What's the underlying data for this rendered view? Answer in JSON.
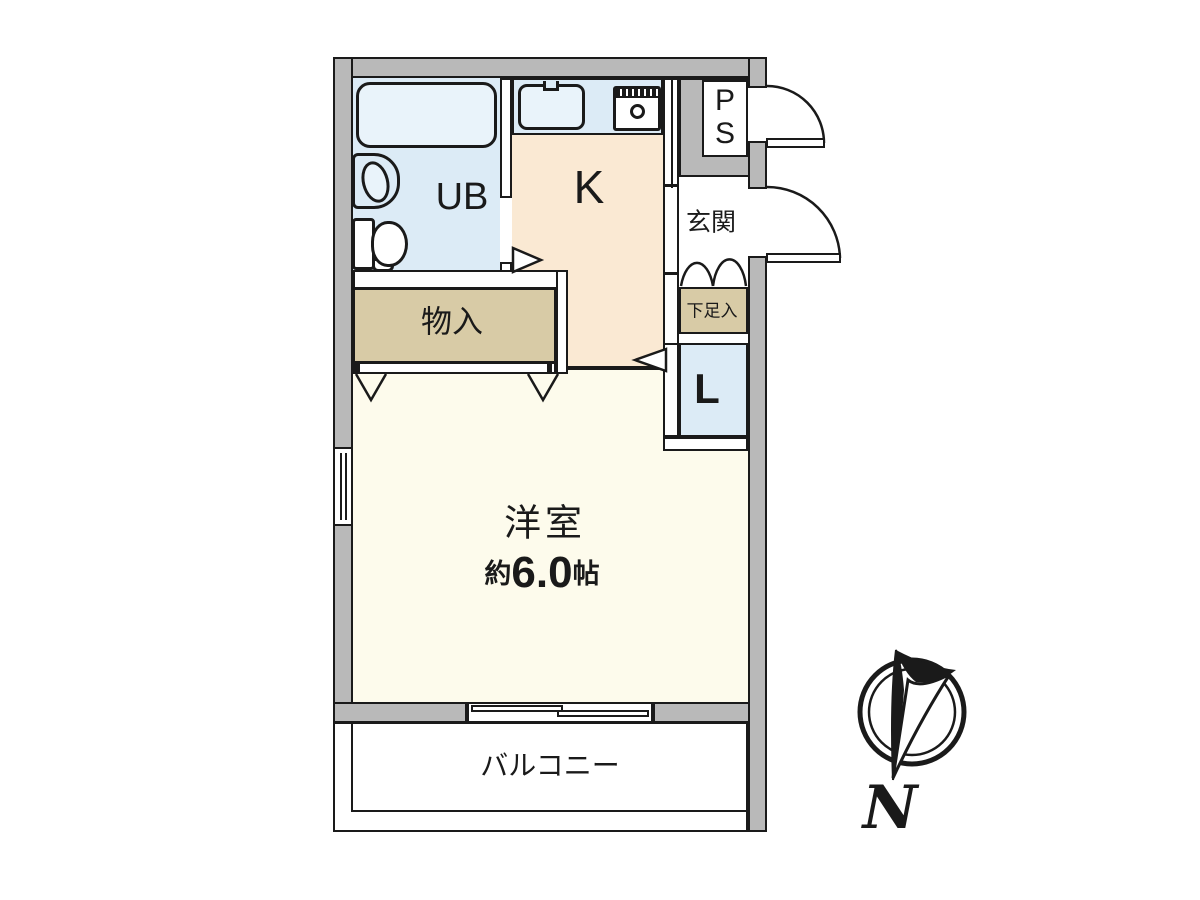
{
  "plan_title": "1K apartment floor plan",
  "colors": {
    "wall": "#b9b9b9",
    "line": "#1a1a1a",
    "blue": "#dcebf6",
    "bluelight": "#e9f3fa",
    "peach": "#fae9d3",
    "cream": "#fdfbec",
    "tan": "#d8cba6",
    "paper": "#ffffff"
  },
  "rooms": {
    "ub": {
      "label": "UB"
    },
    "kitchen": {
      "label": "K"
    },
    "ps": {
      "line1": "P",
      "line2": "S"
    },
    "genkan": {
      "label": "玄関"
    },
    "shoe_box": {
      "label": "下足入"
    },
    "laundry": {
      "label": "L"
    },
    "storage": {
      "label": "物入"
    },
    "western_room": {
      "label": "洋室",
      "size_prefix": "約",
      "size_value": "6.0",
      "size_unit": "帖"
    },
    "balcony": {
      "label": "バルコニー"
    }
  },
  "compass": {
    "label": "N"
  }
}
